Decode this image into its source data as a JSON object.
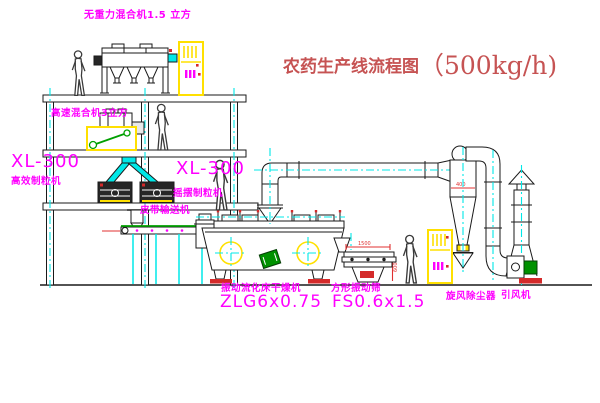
{
  "title": {
    "text": "农药生产线流程图",
    "capacity": "（500kg/h)"
  },
  "equipment_labels": {
    "gravity_free_mixer": "无重力混合机1.5 立方",
    "high_speed_mixer": "高速混合机3立方",
    "granulator_left_model": "XL-300",
    "granulator_left_name": "高效制粒机",
    "granulator_right_model": "XL-300",
    "granulator_right_name": "摇摆制粒机",
    "belt_conveyor": "皮带输送机",
    "dryer_name": "振动流化床干燥机",
    "dryer_model": "ZLG6x0.75",
    "sieve_name": "方形振动筛",
    "sieve_model": "FS0.6x1.5",
    "cyclone": "旋风除尘器",
    "fan": "引风机"
  },
  "dimensions": {
    "sieve_length": "1500",
    "sieve_height": "600",
    "cyclone_diameter": "400"
  },
  "colors": {
    "label_magenta": "#ff00ff",
    "title_red": "#c65353",
    "centerline_cyan": "#00e8e8",
    "accent_yellow": "#ffe000",
    "motor_green": "#009100",
    "base_red": "#d42a2a"
  }
}
